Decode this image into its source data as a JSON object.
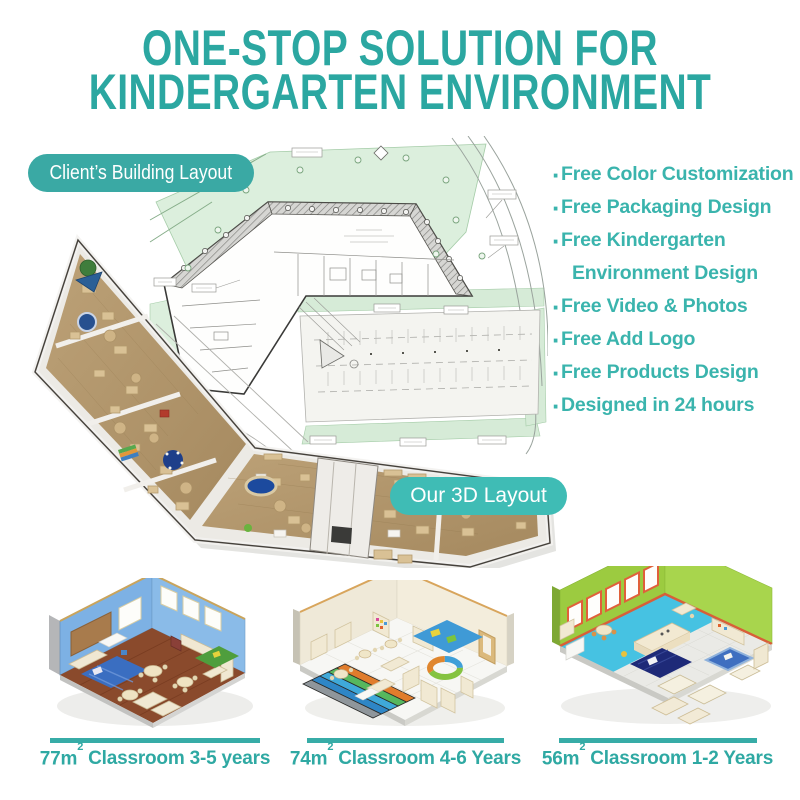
{
  "colors": {
    "accent": "#2ba7a1",
    "badge": "#3aa9a4",
    "badge_light": "#3fbcb5",
    "feature_text": "#3ab4ad",
    "caption_text": "#2fa9a3",
    "caption_bar": "#37aca7"
  },
  "title": {
    "line1": "ONE-STOP SOLUTION FOR",
    "line2": "KINDERGARTEN ENVIRONMENT"
  },
  "badges": {
    "client_layout": "Client’s Building Layout",
    "our_3d": "Our 3D Layout"
  },
  "features": {
    "rows": [
      {
        "bullet": "·",
        "text": "Free Color Customization"
      },
      {
        "bullet": "·",
        "text": "Free Packaging Design"
      },
      {
        "bullet": "·",
        "text": "Free Kindergarten"
      },
      {
        "bullet": "",
        "text": "Environment Design"
      },
      {
        "bullet": "·",
        "text": "Free Video & Photos"
      },
      {
        "bullet": "·",
        "text": "Free Add Logo"
      },
      {
        "bullet": "·",
        "text": "Free Products Design"
      },
      {
        "bullet": "·",
        "text": "Designed in 24 hours"
      }
    ]
  },
  "classrooms": [
    {
      "area": "77m",
      "area_sup": "2",
      "label": "Classroom 3-5 years"
    },
    {
      "area": "74m",
      "area_sup": "2",
      "label": "Classroom 4-6 Years"
    },
    {
      "area": "56m",
      "area_sup": "2",
      "label": "Classroom 1-2 Years"
    }
  ]
}
